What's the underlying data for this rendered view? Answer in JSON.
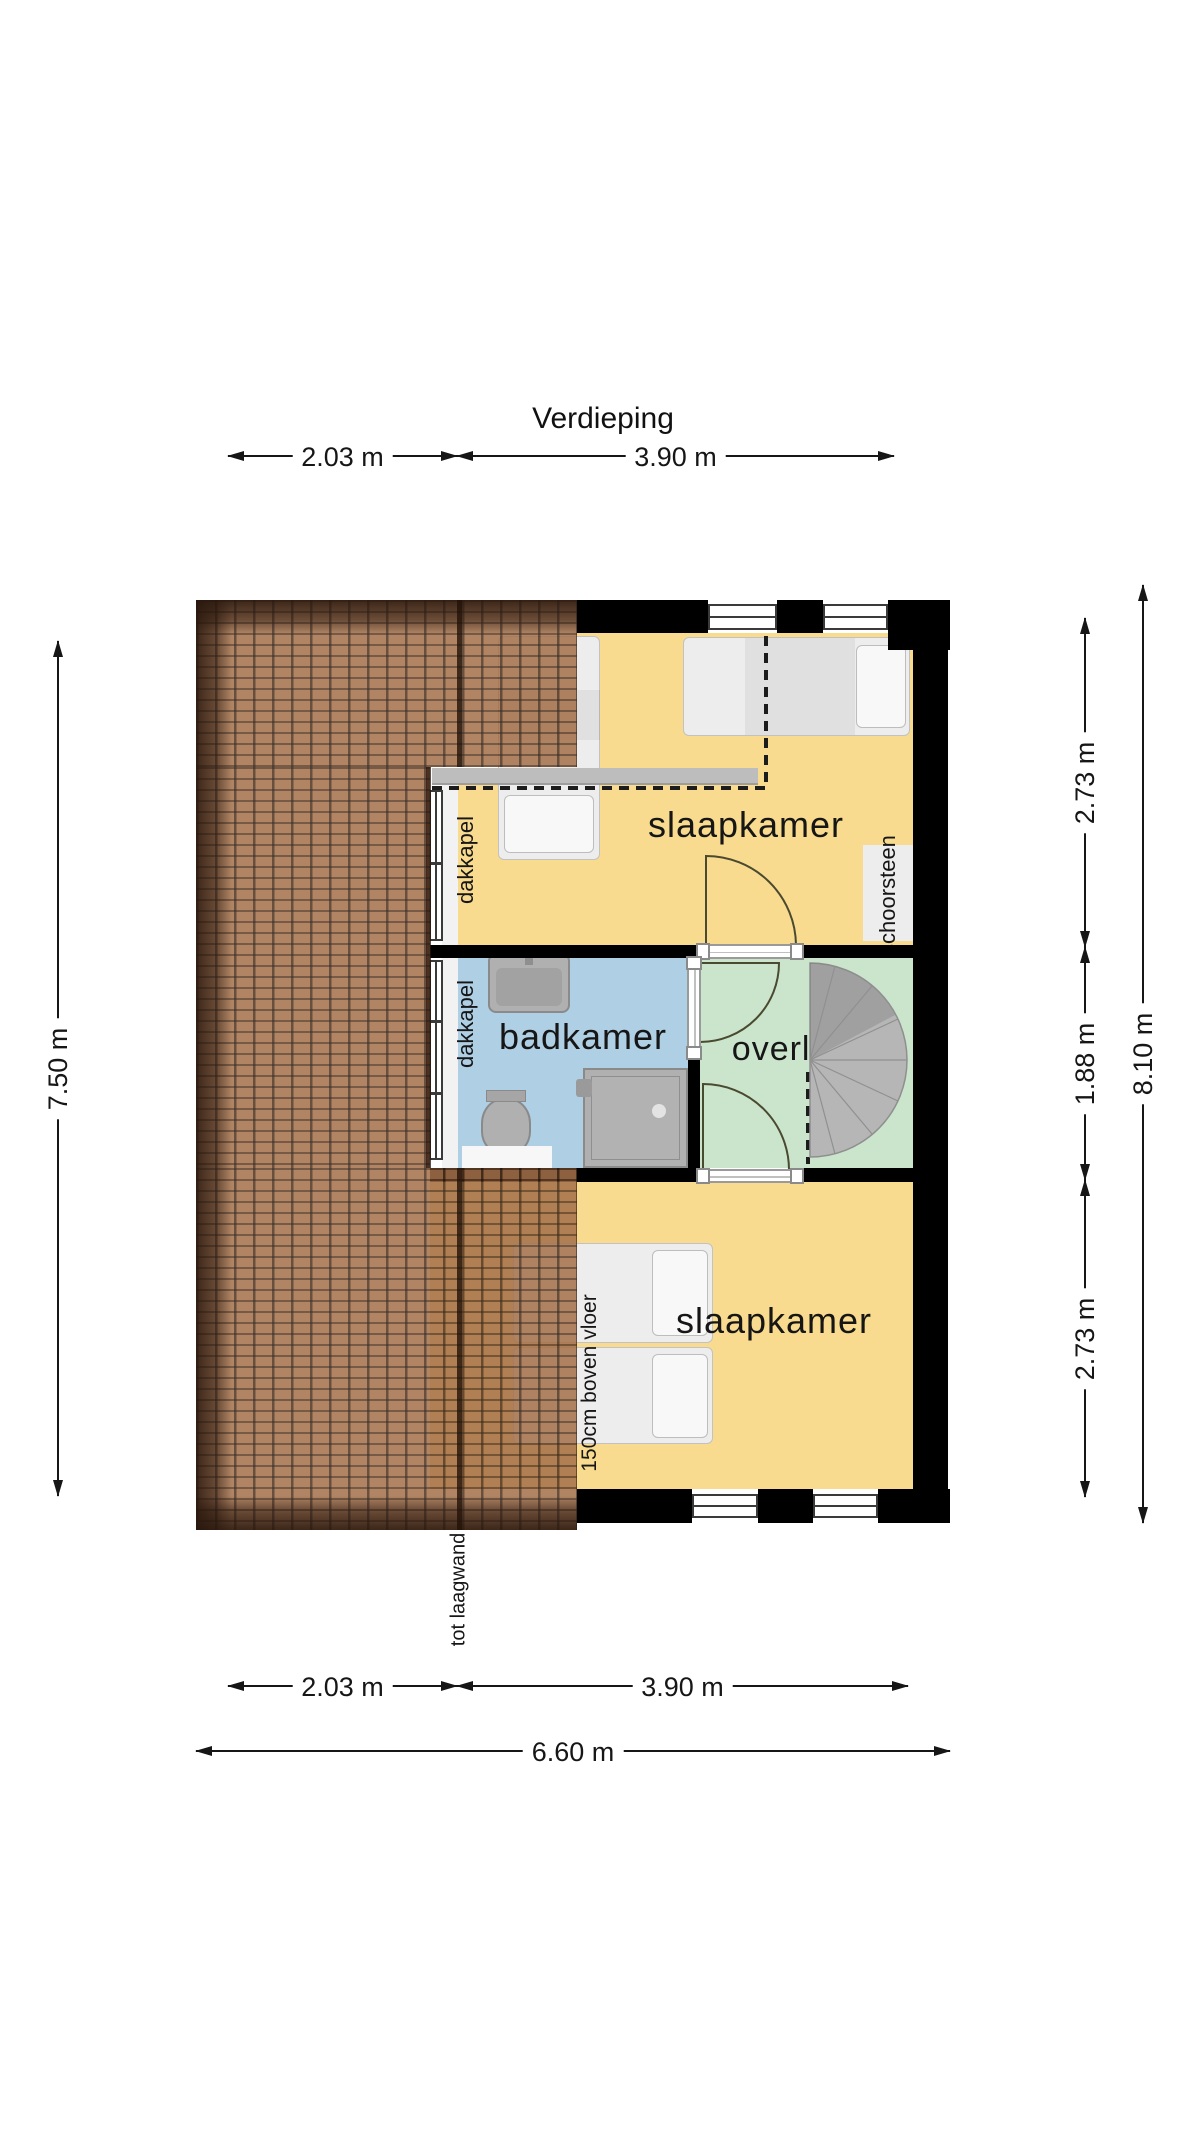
{
  "title": "Verdieping",
  "rooms": {
    "bedroom_top": {
      "label": "slaapkamer"
    },
    "bathroom": {
      "label": "badkamer"
    },
    "landing": {
      "label": "overloop"
    },
    "bedroom_bottom": {
      "label": "slaapkamer"
    }
  },
  "annotations": {
    "dormer_bedroom": "dakkapel",
    "dormer_bathroom": "dakkapel",
    "chimney": "schoorsteen",
    "bed_height_note": "150cm boven vloer",
    "low_wall_note": "tot laagwand"
  },
  "dimensions": {
    "top": [
      {
        "label": "2.03 m"
      },
      {
        "label": "3.90 m"
      }
    ],
    "bottom": [
      {
        "label": "2.03 m"
      },
      {
        "label": "3.90 m"
      }
    ],
    "bottom_total": {
      "label": "6.60 m"
    },
    "left_total": {
      "label": "7.50 m"
    },
    "right": [
      {
        "label": "2.73 m"
      },
      {
        "label": "1.88 m"
      },
      {
        "label": "2.73 m"
      }
    ],
    "right_total": {
      "label": "8.10 m"
    }
  },
  "colors": {
    "floor_yellow": "#F8DB8F",
    "floor_blue": "#AFCFE4",
    "floor_green": "#CBE5CD",
    "roof_brown": "#A5724B",
    "roof_dark": "#3A2113",
    "wall_black": "#000000",
    "knee_wall_gray": "#BDBDBD",
    "fixture_gray": "#B0B0B0",
    "stair_gray": "#B6B6B6"
  }
}
